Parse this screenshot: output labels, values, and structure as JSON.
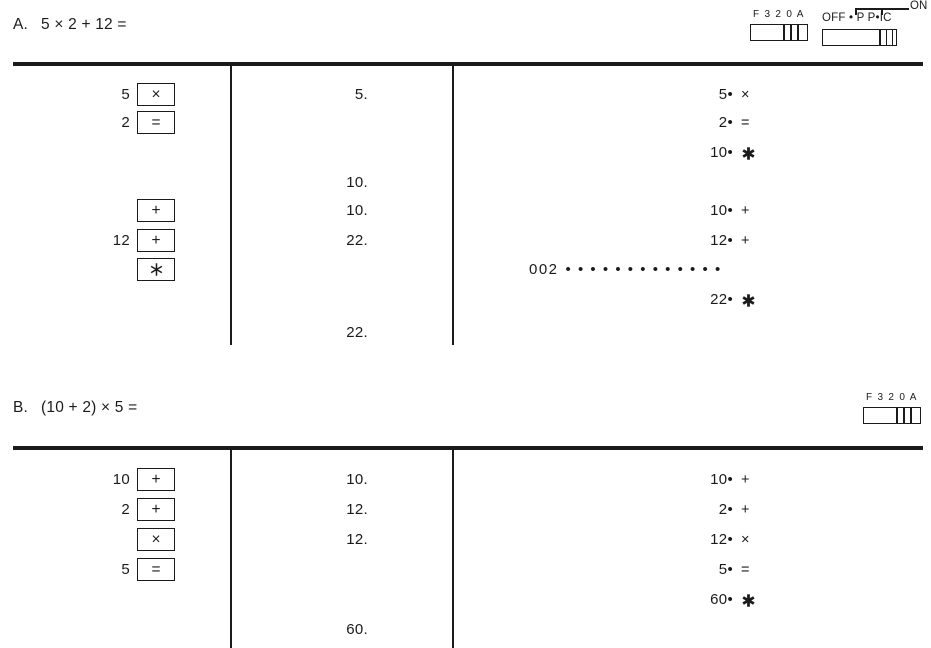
{
  "page": {
    "ink": "#1b1b1b",
    "background": "#ffffff"
  },
  "symbols": {
    "print_dot": "•",
    "total_star": "✱",
    "key_star": "∗"
  },
  "mode_switch": {
    "label": "F 3 2 0 A"
  },
  "power_switch": {
    "labels": "OFF • P P•IC",
    "on": "ON"
  },
  "examples": [
    {
      "label": "A.",
      "expression": "5 × 2 + 12 =",
      "rows": [
        {
          "key_num": "5",
          "key_btn": "×",
          "display": "5.",
          "print_val": "5•",
          "print_op": "×"
        },
        {
          "key_num": "2",
          "key_btn": "=",
          "print_val": "2•",
          "print_op": "="
        },
        {
          "print_val": "10•",
          "print_op": "✱"
        },
        {
          "display": "10."
        },
        {
          "key_btn": "+",
          "display": "10.",
          "print_val": "10•",
          "print_op": "+"
        },
        {
          "key_num": "12",
          "key_btn": "+",
          "display": "22.",
          "print_val": "12•",
          "print_op": "+"
        },
        {
          "key_btn": "∗",
          "tape_count": "002",
          "tape_dots": "•••••••••••••"
        },
        {
          "print_val": "22•",
          "print_op": "✱"
        },
        {
          "display": "22."
        }
      ]
    },
    {
      "label": "B.",
      "expression": "(10 + 2) × 5 =",
      "rows": [
        {
          "key_num": "10",
          "key_btn": "+",
          "display": "10.",
          "print_val": "10•",
          "print_op": "+"
        },
        {
          "key_num": "2",
          "key_btn": "+",
          "display": "12.",
          "print_val": "2•",
          "print_op": "+"
        },
        {
          "key_btn": "×",
          "display": "12.",
          "print_val": "12•",
          "print_op": "×"
        },
        {
          "key_num": "5",
          "key_btn": "=",
          "print_val": "5•",
          "print_op": "="
        },
        {
          "print_val": "60•",
          "print_op": "✱"
        },
        {
          "display": "60."
        }
      ]
    }
  ]
}
